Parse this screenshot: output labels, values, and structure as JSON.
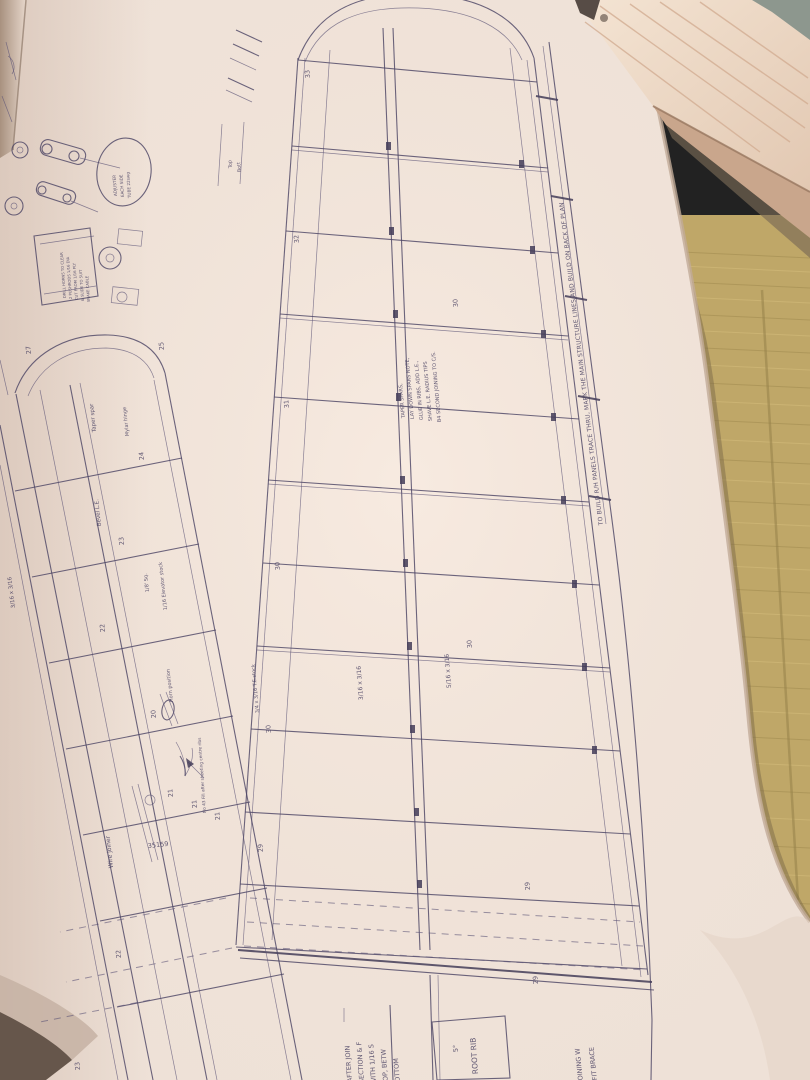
{
  "scene": {
    "subject": "Model aircraft wing plan sheet unrolled on tatami floor beside a wooden beam",
    "colors": {
      "paper": "#eee1d7",
      "ink": "#4d4565",
      "tatami": "#bfa768",
      "wood": "#eed9c6",
      "shadow_dark": "#66564b"
    }
  },
  "plan": {
    "edge_note": "TO BUILD R/H PANELS TRACE THRU, MARK THE MAIN STRUCTURE LINES AND BUILD ON BACK OF PLAN",
    "build_note": [
      "TAPER SPARS,",
      "LAY DOWN SPARS NOTE,",
      "GLUE IN RIBS, ADD L.E.,",
      "SHAVE L.E. RADIUS TIPS",
      "B4 SECOND JOINING TO C/S."
    ],
    "root_rib": {
      "label": "ROOT RIB",
      "angle": "5°"
    },
    "after_join_note": [
      "AFTER JOIN",
      "SECTION & F",
      "WITH 1/16 S",
      "TOP, BETW",
      "BOTTOM"
    ],
    "fit_brace_note": [
      "FIT BRACE",
      "JOINING W"
    ],
    "fill_note": "No 43 Fill after sheeting centre ribs",
    "labels": {
      "wire_joiner": "Wire joiner",
      "horn_position": "Horn position",
      "elevator_stock": "1/16 Elevator stock",
      "eighth_sq": "1/8' Sq.",
      "te_stock": "3/4 x 3/16 T.E.stock",
      "spar_316": "3/16 x 3/16",
      "le_51616": "5/16 x 3/16",
      "stab_316": "3/16 x 3/16",
      "taper_spar": "Taper spar",
      "mylar_hinge": "Mylar hinge",
      "bevel_le": "Bevel L.E.",
      "plan_number": "35159"
    },
    "balloon_note": [
      "ADJUSTER",
      "EACH SIDE",
      "TUBE 22swg"
    ],
    "detail_note": [
      "DRILL HORNS TO CLEAR",
      "2 PUSHRODS 1/16 DIA",
      "CUT FROM 1/16 PLY",
      "& SLIDE TO SUIT",
      "SNAKE CABLE"
    ],
    "bracket_rows": [
      "Top",
      "Bott"
    ],
    "main_panel_ribs": [
      "33",
      "32",
      "31",
      "30",
      "30",
      "29",
      "30",
      "30",
      "29",
      "29"
    ],
    "left_panel_ribs": [
      "27",
      "25",
      "24",
      "23",
      "22",
      "20",
      "21",
      "21",
      "21",
      "22",
      "23"
    ]
  }
}
